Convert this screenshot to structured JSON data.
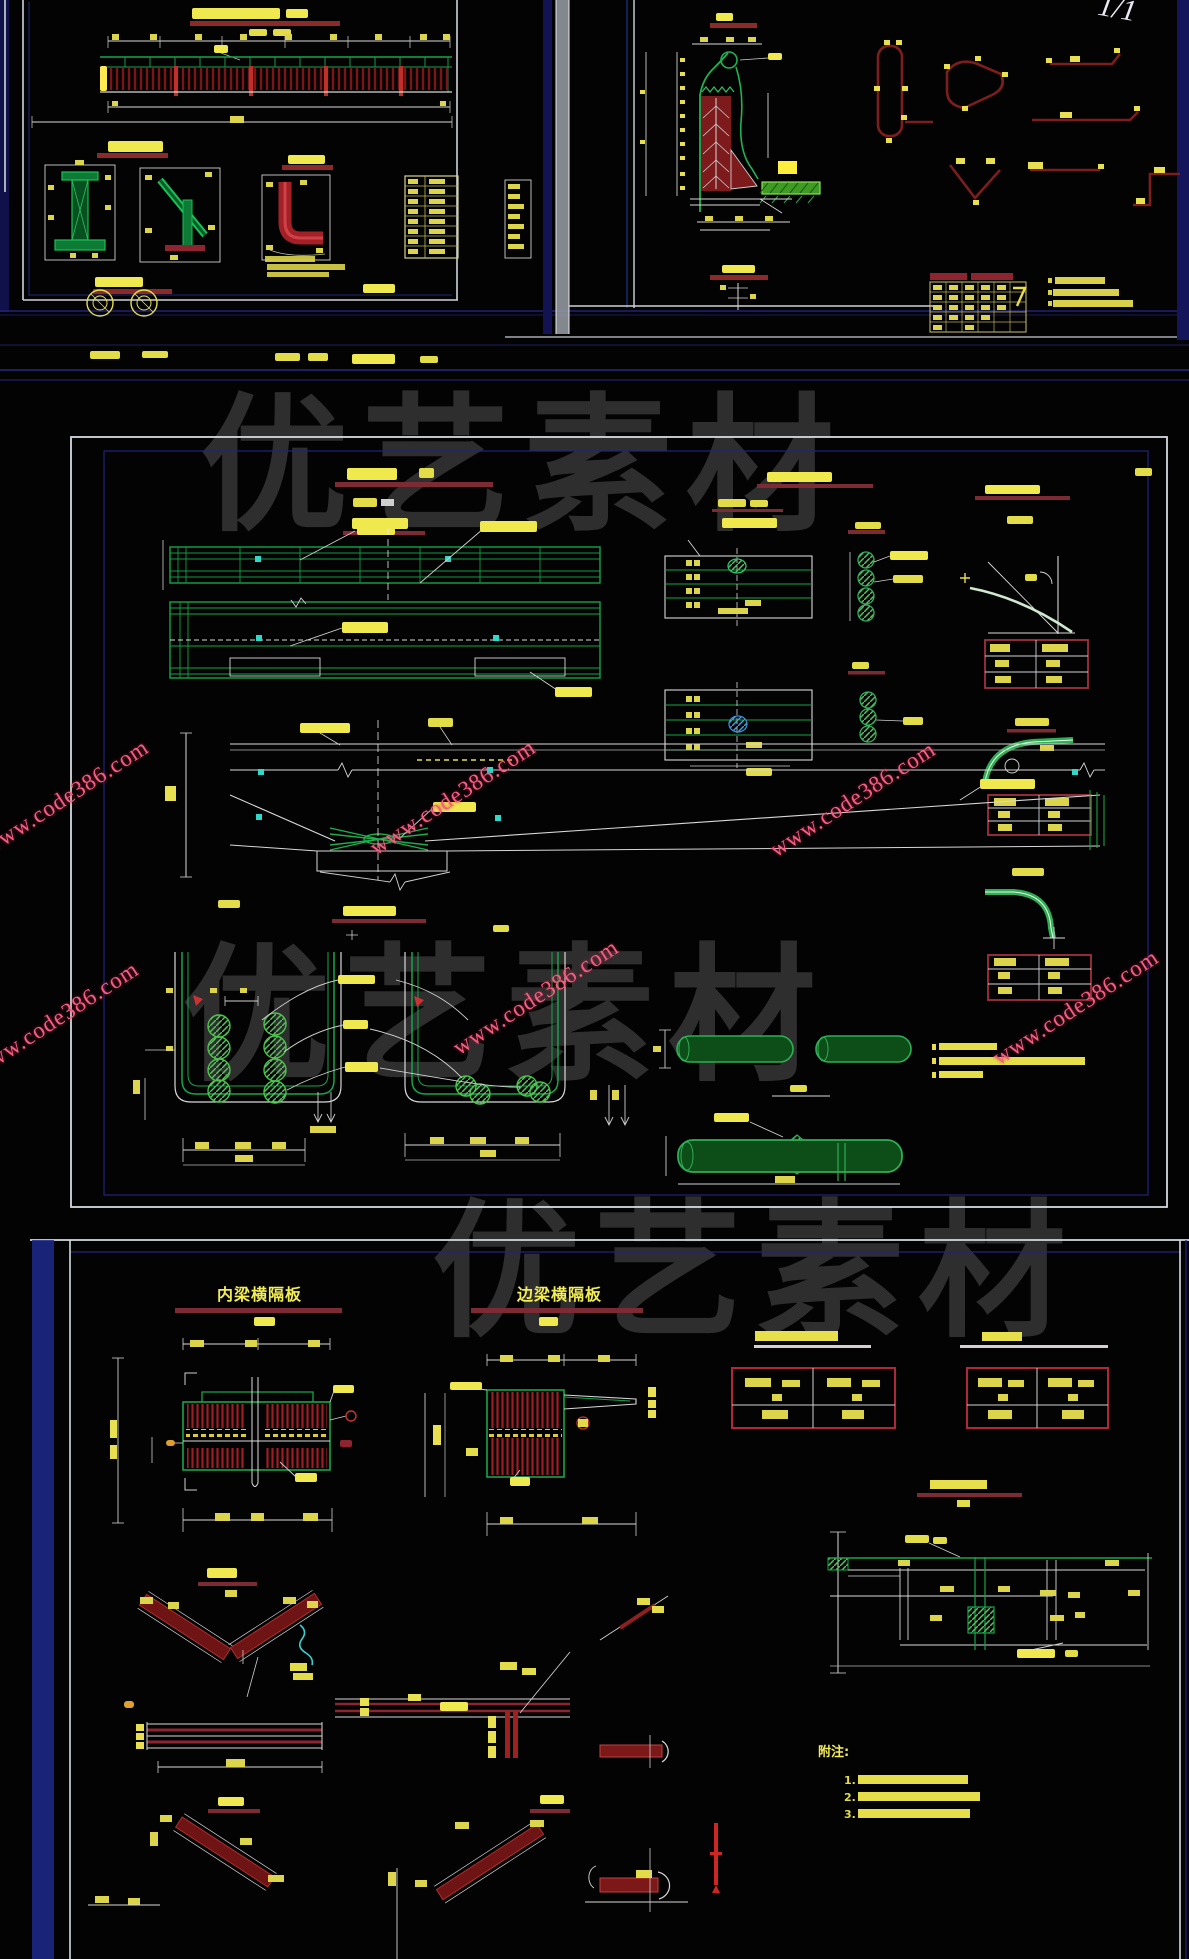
{
  "watermarks": {
    "brand_text": "优艺素材",
    "site_text": "www.code386.com",
    "brand_color": "#2e2e2e",
    "site_color": "#f25f7f"
  },
  "top_right_sheet": {
    "handwriting_mark": "1/1"
  },
  "bottom_panel": {
    "inner_title": "内梁横隔板",
    "edge_title": "边梁横隔板",
    "notes_heading": "附注:",
    "notes": [
      {
        "num": "1."
      },
      {
        "num": "2."
      },
      {
        "num": "3."
      }
    ]
  },
  "colors": {
    "cad_green": "#17a44b",
    "cad_yellow": "#e8e050",
    "hatch_red": "#a01d22",
    "crimson_bar": "#8e2430",
    "navy_line": "#232380",
    "cyan_marker": "#35d8c8",
    "dim_white": "#d8d8d8"
  }
}
